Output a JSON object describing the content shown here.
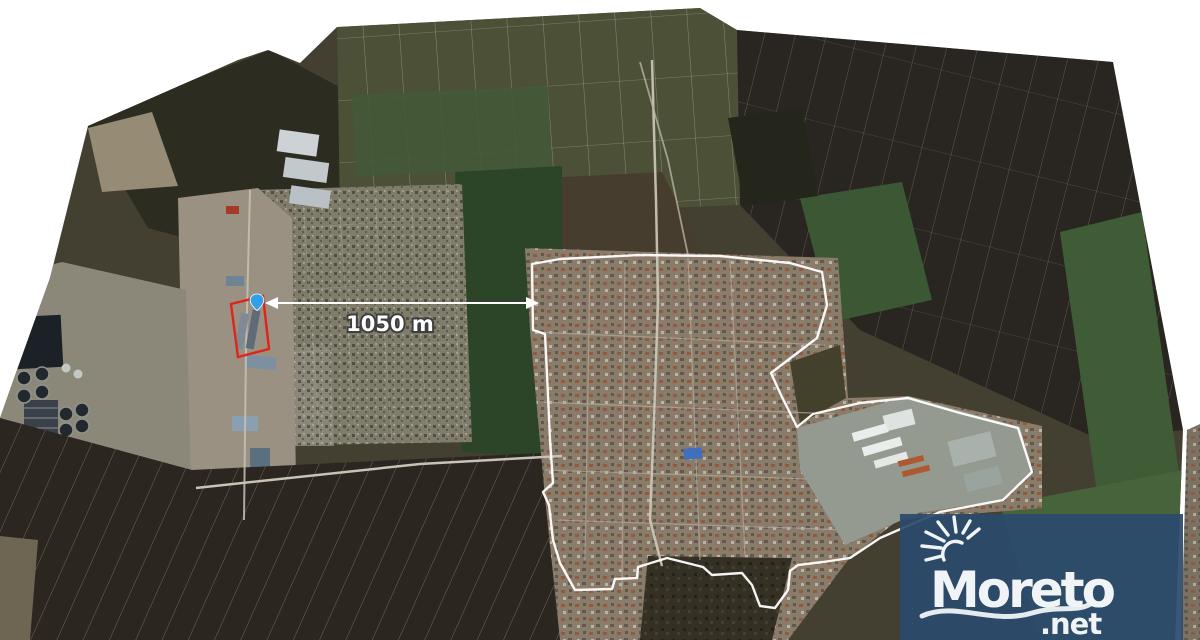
{
  "map": {
    "type": "satellite-photo-mosaic",
    "annotations": {
      "distance_label": "1050 m",
      "parcel_outline_color": "#e2231a",
      "boundary_color": "#ffffff",
      "marker_color": "#2da0e8",
      "arrow_color": "#ffffff",
      "icons": {
        "location_marker": "map-pin",
        "distance_arrow": "double-headed-arrow"
      }
    }
  },
  "watermark": {
    "brand": "Moreto",
    "tld": ".net",
    "background_color": "#2b4a6d",
    "text_color": "#f0f4f6",
    "icons": {
      "sun": "sun-rays",
      "wave": "wave-swoosh"
    }
  }
}
